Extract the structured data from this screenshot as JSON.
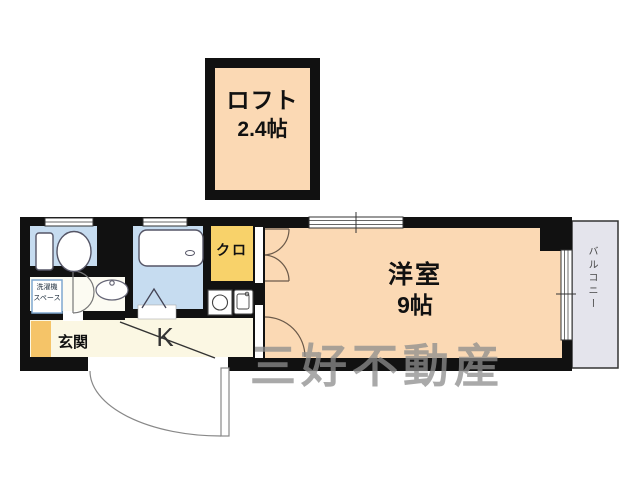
{
  "plan": {
    "loft": {
      "name": "ロフト",
      "area": "2.4帖"
    },
    "main_room": {
      "name": "洋室",
      "area": "9帖"
    },
    "kitchen_label": "K",
    "closet_label": "クロ",
    "entrance_label": "玄関",
    "balcony_label": "バルコニー",
    "laundry_space": {
      "line1": "洗濯機",
      "line2": "スペース"
    },
    "watermark": "三好不動産"
  },
  "icons": {
    "toilet": "toilet-icon",
    "bathtub": "bathtub-icon",
    "washbasin": "washbasin-icon",
    "stove": "stove-burner-icon",
    "kitchen_sink": "kitchen-sink-icon",
    "doors": "door-swing-arc-icon",
    "windows": "sliding-window-icon"
  },
  "colors": {
    "wall": "#111111",
    "room_peach": "#fbd9b4",
    "wet_blue": "#c6dcf0",
    "closet_yellow": "#f8d26a",
    "floor_cream": "#fbf7e3",
    "washroom_white": "#fcfbf2",
    "balcony_gray": "#e4e4ec",
    "shoe_cabinet_yellow": "#f5c468",
    "fixture_outline": "#555555",
    "watermark_gray": "#8d8d8d"
  }
}
